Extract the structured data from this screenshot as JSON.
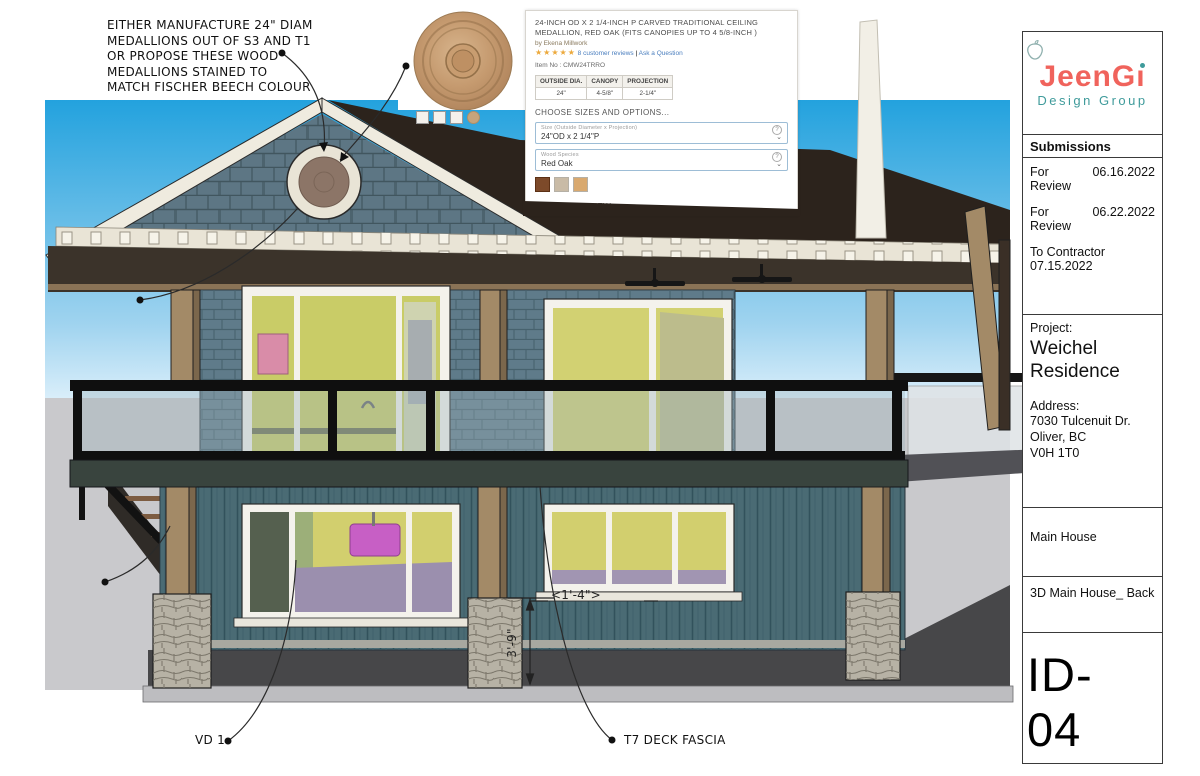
{
  "colors": {
    "sky_top": "#2aa7e0",
    "sky_bottom": "#d9eefa",
    "ground": "#c9c9cc",
    "siding_upper": "#5f7b8a",
    "siding_lower": "#4a6b74",
    "roof_dark": "#2c231c",
    "trim_white": "#e9e4d6",
    "wood_post": "#a38a67",
    "brand_coral": "#f0635c",
    "brand_teal": "#3f9b9b",
    "interior_yellow": "#d2cf6e",
    "interior_purple": "#9b8fae",
    "sink_magenta": "#c75fc5"
  },
  "annotations": {
    "medallion_note": "EITHER MANUFACTURE 24\" DIAM\nMEDALLIONS OUT OF S3 AND T1\nOR PROPOSE THESE WOOD\nMEDALLIONS STAINED TO\nMATCH FISCHER BEECH COLOUR",
    "center_note": "CENTER OF\nMEDALLION\nSITS AT\n1'-10\"\nFROM PEEK",
    "cd1_note": "CD 1\nAT\nSTAIRS",
    "vd1_label": "VD 1",
    "t7_label": "T7 DECK FASCIA",
    "dim_width": "<1'-4\">",
    "dim_height": "3'-9\""
  },
  "product_card": {
    "title": "24-INCH OD X 2 1/4-INCH P CARVED TRADITIONAL CEILING MEDALLION, RED OAK (FITS CANOPIES UP TO 4 5/8-INCH )",
    "byline": "by Ekena Millwork",
    "stars": "★★★★★",
    "reviews_link": "8 customer reviews",
    "links_divider": "|",
    "ask_link": "Ask a Question",
    "item_no": "Item No : CMW24TRRO",
    "spec_table": {
      "headers": [
        "OUTSIDE DIA.",
        "CANOPY",
        "PROJECTION"
      ],
      "values": [
        "24\"",
        "4-5/8\"",
        "2-1/4\""
      ]
    },
    "options_heading": "CHOOSE SIZES AND OPTIONS...",
    "size_label": "Size (Outside Diameter x Projection)",
    "size_value": "24\"OD x 2 1/4\"P",
    "species_label": "Wood Species",
    "species_value": "Red Oak",
    "swatches": [
      "#7d4a2a",
      "#c9bba6",
      "#d9a96f"
    ],
    "overview_heading": "QUICK OVERVIEW",
    "icons": {
      "help": "?",
      "chevron": "⌄"
    }
  },
  "title_block": {
    "brand": {
      "name_main": "JeenG",
      "name_i": "ı",
      "tagline": "Design Group"
    },
    "submissions": {
      "heading": "Submissions",
      "entries": [
        {
          "label": "For Review",
          "date": "06.16.2022"
        },
        {
          "label": "For Review",
          "date": "06.22.2022"
        },
        {
          "label": "To Contractor",
          "date": "07.15.2022"
        }
      ]
    },
    "project": {
      "label": "Project:",
      "name": "Weichel\nResidence",
      "address_label": "Address:",
      "address": "7030 Tulcenuit Dr.\nOliver, BC\nV0H 1T0"
    },
    "scope": "Main House",
    "view_name": "3D Main House_ Back",
    "sheet_id": "ID- 04"
  }
}
